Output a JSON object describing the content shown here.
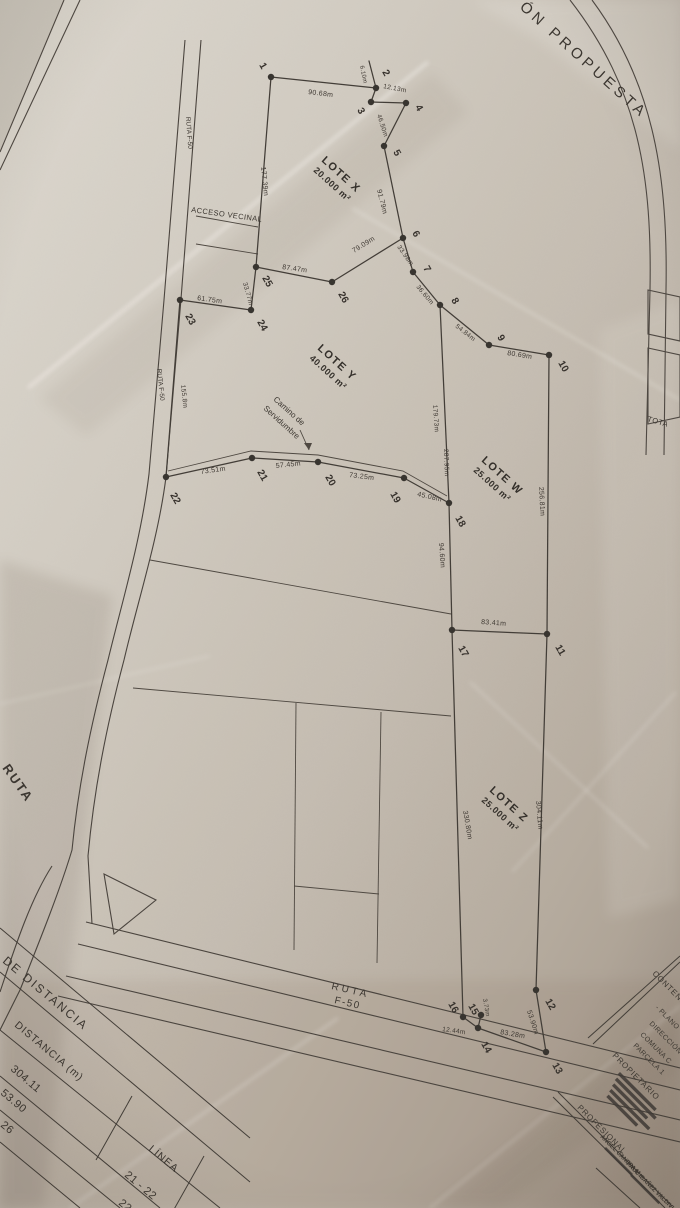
{
  "sheet": {
    "title_fragment": "ÓN PROPUESTA",
    "total_fragment": "TOTA"
  },
  "plan": {
    "vertices": [
      {
        "n": "1",
        "x": 271,
        "y": 77,
        "lx": 259,
        "ly": 65
      },
      {
        "n": "2",
        "x": 376,
        "y": 88,
        "lx": 382,
        "ly": 72
      },
      {
        "n": "3",
        "x": 371,
        "y": 102,
        "lx": 357,
        "ly": 110
      },
      {
        "n": "4",
        "x": 406,
        "y": 103,
        "lx": 415,
        "ly": 107
      },
      {
        "n": "5",
        "x": 384,
        "y": 146,
        "lx": 393,
        "ly": 152
      },
      {
        "n": "6",
        "x": 403,
        "y": 238,
        "lx": 412,
        "ly": 233
      },
      {
        "n": "7",
        "x": 413,
        "y": 272,
        "lx": 423,
        "ly": 268
      },
      {
        "n": "8",
        "x": 440,
        "y": 305,
        "lx": 451,
        "ly": 300
      },
      {
        "n": "9",
        "x": 489,
        "y": 345,
        "lx": 497,
        "ly": 337
      },
      {
        "n": "10",
        "x": 549,
        "y": 355,
        "lx": 558,
        "ly": 363
      },
      {
        "n": "11",
        "x": 547,
        "y": 634,
        "lx": 555,
        "ly": 647
      },
      {
        "n": "12",
        "x": 536,
        "y": 990,
        "lx": 545,
        "ly": 1001
      },
      {
        "n": "13",
        "x": 546,
        "y": 1052,
        "lx": 552,
        "ly": 1065
      },
      {
        "n": "14",
        "x": 478,
        "y": 1028,
        "lx": 481,
        "ly": 1044
      },
      {
        "n": "15",
        "x": 481,
        "y": 1015,
        "lx": 468,
        "ly": 1006
      },
      {
        "n": "16",
        "x": 463,
        "y": 1017,
        "lx": 448,
        "ly": 1004
      },
      {
        "n": "17",
        "x": 452,
        "y": 630,
        "lx": 458,
        "ly": 648
      },
      {
        "n": "18",
        "x": 449,
        "y": 503,
        "lx": 455,
        "ly": 518
      },
      {
        "n": "19",
        "x": 404,
        "y": 478,
        "lx": 390,
        "ly": 494
      },
      {
        "n": "20",
        "x": 318,
        "y": 462,
        "lx": 325,
        "ly": 477
      },
      {
        "n": "21",
        "x": 252,
        "y": 458,
        "lx": 257,
        "ly": 472
      },
      {
        "n": "22",
        "x": 166,
        "y": 477,
        "lx": 170,
        "ly": 495
      },
      {
        "n": "23",
        "x": 180,
        "y": 300,
        "lx": 185,
        "ly": 316
      },
      {
        "n": "24",
        "x": 251,
        "y": 310,
        "lx": 257,
        "ly": 322
      },
      {
        "n": "25",
        "x": 256,
        "y": 267,
        "lx": 262,
        "ly": 278
      },
      {
        "n": "26",
        "x": 332,
        "y": 282,
        "lx": 338,
        "ly": 294
      }
    ],
    "edges": [
      [
        "1",
        "2"
      ],
      [
        "2",
        "3"
      ],
      [
        "3",
        "4"
      ],
      [
        "4",
        "5"
      ],
      [
        "5",
        "6"
      ],
      [
        "6",
        "7"
      ],
      [
        "7",
        "8"
      ],
      [
        "8",
        "9"
      ],
      [
        "9",
        "10"
      ],
      [
        "10",
        "11"
      ],
      [
        "11",
        "12"
      ],
      [
        "12",
        "13"
      ],
      [
        "13",
        "14"
      ],
      [
        "14",
        "15"
      ],
      [
        "14",
        "16"
      ],
      [
        "11",
        "17"
      ],
      [
        "17",
        "18"
      ],
      [
        "8",
        "18"
      ],
      [
        "18",
        "19"
      ],
      [
        "19",
        "20"
      ],
      [
        "20",
        "21"
      ],
      [
        "21",
        "22"
      ],
      [
        "22",
        "23"
      ],
      [
        "23",
        "24"
      ],
      [
        "24",
        "25"
      ],
      [
        "25",
        "1"
      ],
      [
        "25",
        "26"
      ],
      [
        "26",
        "6"
      ],
      [
        "17",
        "16"
      ]
    ],
    "free_edges": [
      [
        376,
        88,
        369,
        61
      ]
    ],
    "measurements": [
      {
        "t": "90.68m",
        "x": 308,
        "y": 94,
        "r": 7
      },
      {
        "t": "6.10m",
        "x": 360,
        "y": 66,
        "r": 78,
        "fs": 6
      },
      {
        "t": "12.13m",
        "x": 383,
        "y": 88,
        "r": 11,
        "fs": 6.5
      },
      {
        "t": "46.50m",
        "x": 377,
        "y": 115,
        "r": 72,
        "fs": 6.5
      },
      {
        "t": "91.79m",
        "x": 377,
        "y": 190,
        "r": 76
      },
      {
        "t": "33.98m",
        "x": 397,
        "y": 247,
        "r": 55,
        "fs": 6.5
      },
      {
        "t": "36.60m",
        "x": 416,
        "y": 287,
        "r": 50,
        "fs": 6.5
      },
      {
        "t": "54.84m",
        "x": 455,
        "y": 327,
        "r": 38,
        "fs": 6.5
      },
      {
        "t": "80.69m",
        "x": 507,
        "y": 355,
        "r": 9
      },
      {
        "t": "256.81m",
        "x": 539,
        "y": 487,
        "r": 87
      },
      {
        "t": "177.39m",
        "x": 261,
        "y": 167,
        "r": 84
      },
      {
        "t": "87.47m",
        "x": 282,
        "y": 269,
        "r": 8
      },
      {
        "t": "79.09m",
        "x": 354,
        "y": 253,
        "r": -32
      },
      {
        "t": "33.77m",
        "x": 243,
        "y": 283,
        "r": 75,
        "fs": 6.5
      },
      {
        "t": "61.75m",
        "x": 197,
        "y": 300,
        "r": 8
      },
      {
        "t": "155.8m",
        "x": 181,
        "y": 385,
        "r": 84,
        "fs": 6.5
      },
      {
        "t": "73.51m",
        "x": 201,
        "y": 474,
        "r": -8
      },
      {
        "t": "57.45m",
        "x": 276,
        "y": 468,
        "r": -6
      },
      {
        "t": "73.25m",
        "x": 349,
        "y": 477,
        "r": 7
      },
      {
        "t": "45.08m",
        "x": 417,
        "y": 496,
        "r": 13
      },
      {
        "t": "179.73m",
        "x": 433,
        "y": 405,
        "r": 86,
        "fs": 6.5
      },
      {
        "t": "287.95m",
        "x": 444,
        "y": 449,
        "r": 88,
        "fs": 6.5
      },
      {
        "t": "94.60m",
        "x": 439,
        "y": 543,
        "r": 86
      },
      {
        "t": "83.41m",
        "x": 481,
        "y": 624,
        "r": 4
      },
      {
        "t": "330.80m",
        "x": 463,
        "y": 811,
        "r": 80
      },
      {
        "t": "304.11m",
        "x": 536,
        "y": 801,
        "r": 85
      },
      {
        "t": "53.90m",
        "x": 527,
        "y": 1011,
        "r": 72
      },
      {
        "t": "3.73m",
        "x": 483,
        "y": 999,
        "r": 80,
        "fs": 6
      },
      {
        "t": "83.28m",
        "x": 500,
        "y": 1034,
        "r": 10
      },
      {
        "t": "12.44m",
        "x": 442,
        "y": 1031,
        "r": 8,
        "fs": 6.5
      }
    ],
    "lots": [
      {
        "name": "LOTE X",
        "area": "20.000 m²",
        "x": 321,
        "y": 161,
        "r": 42
      },
      {
        "name": "LOTE Y",
        "area": "40.000 m²",
        "x": 317,
        "y": 349,
        "r": 42
      },
      {
        "name": "LOTE W",
        "area": "25.000 m²",
        "x": 481,
        "y": 461,
        "r": 42
      },
      {
        "name": "LOTE Z",
        "area": "25.000 m²",
        "x": 489,
        "y": 791,
        "r": 42
      }
    ],
    "annotations": [
      {
        "id": "sheet-title",
        "t": "ÓN PROPUESTA",
        "x": 519,
        "y": 8,
        "r": 42,
        "fs": 15,
        "sp": 4,
        "w": 400
      },
      {
        "id": "acceso-vecinal",
        "t": "ACCESO VECINAL",
        "x": 191,
        "y": 212,
        "r": 8,
        "fs": 7.5,
        "sp": 0.4
      },
      {
        "id": "camino-line1",
        "t": "Camino de",
        "x": 273,
        "y": 400,
        "r": 42,
        "fs": 8
      },
      {
        "id": "camino-line2",
        "t": "Servidumbre",
        "x": 263,
        "y": 409,
        "r": 42,
        "fs": 8
      },
      {
        "id": "ruta-f50-vertical-top",
        "t": "RUTA F-50",
        "x": 186,
        "y": 117,
        "r": 86,
        "fs": 6.5
      },
      {
        "id": "ruta-f50-vertical-mid",
        "t": "RUTA F-50",
        "x": 157,
        "y": 369,
        "r": 84,
        "fs": 6.5
      },
      {
        "id": "ruta-left-edge",
        "t": "RUTA",
        "x": 2,
        "y": 768,
        "r": 55,
        "fs": 13,
        "sp": 2,
        "w": 700
      },
      {
        "id": "ruta-f50-bottom-line1",
        "t": "RUTA",
        "x": 331,
        "y": 989,
        "r": 13,
        "fs": 10,
        "sp": 3
      },
      {
        "id": "ruta-f50-bottom-line2",
        "t": "F-50",
        "x": 334,
        "y": 1003,
        "r": 13,
        "fs": 10,
        "sp": 1.5
      },
      {
        "id": "total-fragment",
        "t": "TOTA",
        "x": 647,
        "y": 421,
        "r": 16,
        "fs": 7.5,
        "sp": 0.5
      }
    ]
  },
  "distance_table": {
    "title": "DE DISTANCIA",
    "distancia_header": "DISTANCIA (m)",
    "linea_header": "LÍNEA",
    "distancia_values": [
      "304.11",
      "53.90",
      "26"
    ],
    "linea_values": [
      "21 - 22",
      "22 -"
    ]
  },
  "title_block": {
    "contenido": "CONTENIDO",
    "item_plano": "-   PLANO",
    "direccion": "DIRECCIÓN",
    "comuna": "COMUNA C",
    "parcela": "PARCELA 1",
    "propietario": "PROPIETARIO",
    "profesional": "PROFESIONAL",
    "nombre_1": "ANGEL CANEPA M.",
    "nombre_2": "PAUL IBAÑEZ VALDIVIA"
  }
}
